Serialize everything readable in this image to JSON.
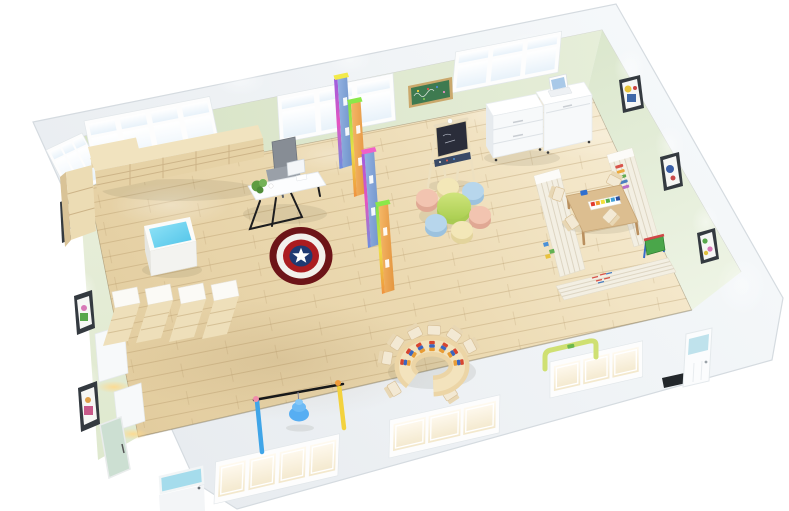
{
  "scene": {
    "title": "Kindergarten classroom 3D floor plan render",
    "description": "Top-down oblique 3D rendering of a furnished kindergarten classroom; no visible text in the image",
    "room_type": "kindergarten classroom",
    "view": "isometric bird's-eye cutaway"
  },
  "palette": {
    "bg": "#ffffff",
    "wall-outer-light": "#f5f8fa",
    "wall-outer-dark": "#e7ebef",
    "wall-edge": "#d5dbe0",
    "seam": "rgba(150,150,130,0.35)",
    "baseline": "rgba(125,115,90,0.45)",
    "wall-green-dark": "#d6e2c4",
    "wall-green-light": "#e6eed9",
    "floor-dark": "#e2cc9e",
    "floor-mid": "#ecdab2",
    "floor-light": "#f6ebd1",
    "plank-line": "rgba(172,142,94,0.33)",
    "plank-seam": "rgba(172,142,94,0.2)",
    "window-frame": "#fdfdfd",
    "door-pane-cyan": "#a5dcec",
    "glass-door-green": "#ccdfd2",
    "doormat": "#23272b",
    "wood-shelf-top": "#f1e3bf",
    "wood-shelf-front": "#e6d2a6",
    "wood-shelf-line": "#cdb488",
    "wood-cabinet": "#ecdcb4",
    "wood-cabinet-side": "#d9c397",
    "white-furn": "#f7f9fa",
    "white-furn-shade": "#e7ebee",
    "desk-white": "#fcfdfe",
    "desk-leg": "#1d1d1f",
    "chair-gray": "#878d95",
    "screen-blue": "#a9c9e8",
    "plant-green": "#5e9c41",
    "rug-maroon": "#6d1418",
    "rug-white": "#f2f0ec",
    "rug-red": "#ab1c20",
    "rug-blue": "#1f3a72",
    "divider-blue-a": "#93b2e2",
    "divider-blue-b": "#7093ca",
    "divider-orange-a": "#f5b868",
    "divider-orange-b": "#e4953f",
    "divider-cap-yellow": "#f2ea4a",
    "divider-cap-green": "#8ae84a",
    "divider-cap-magenta": "#f060c8",
    "chalk-green": "#3e7a50",
    "chalk-frame": "#caa86c",
    "easel-wood": "#ede0c0",
    "easel-board": "#2a2d3a",
    "easel-tray": "#3a4a66",
    "flower-center-side": "#a9cb52",
    "petal-pink": "#f2c4b0",
    "petal-blue": "#b7d6ec",
    "petal-cream": "#f3e7b8",
    "corner-shelf": "#f3efe3",
    "corner-shelf-line": "#ddd5c2",
    "table-wood": "#dcbe90",
    "table-wood-edge": "#c6a474",
    "chair-wood": "#e8d7b4",
    "seat-cream": "#f3e9d4",
    "paint-red": "#e23b2e",
    "paint-orange": "#f09b2d",
    "paint-yellow": "#f3df3a",
    "paint-green": "#58b04c",
    "paint-skyblue": "#3f9fd8",
    "paint-navy": "#2b4fa0",
    "toy-red": "#d64530",
    "toy-blue": "#3a66c0",
    "toy-orange": "#e89c35",
    "toy-easel-green": "#4aa64a",
    "horseshoe-wood": "#ecd5a6",
    "horseshoe-rim": "#f3e3bd",
    "step-back": "#fbfaf6",
    "step-wood": "#eedfba",
    "step-line": "#d6c196",
    "swing-bar-black": "#17181a",
    "swing-post-blue": "#3fa5e8",
    "swing-post-yellow": "#f3d23e",
    "swing-cap-pink": "#f08caa",
    "swing-cap-orange": "#f09b3a",
    "swing-hang-blue": "#57aef2",
    "bench-green": "#cfe072",
    "frame-dark": "#343a40"
  },
  "room": {
    "walls": {
      "back_wall": {
        "window_groups": 3,
        "chalkboard": true
      },
      "left_wall": {
        "window_groups": 1,
        "pictures": 3,
        "wall_cabinets": 2,
        "glass_door": true
      },
      "right_wall": {
        "pictures": 3,
        "spotlights": 4
      },
      "front_wall": {
        "window_groups": 3,
        "doors": 2,
        "doormat": true
      }
    },
    "furniture": [
      {
        "name": "open-bookshelf",
        "location": "along back wall, left side"
      },
      {
        "name": "corner-cabinet",
        "location": "top-left corner"
      },
      {
        "name": "sensory-table",
        "desc": "white cube table with cyan top"
      },
      {
        "name": "teacher-desk",
        "desc": "white desk, black trestle legs, laptop, plant, gray office chair"
      },
      {
        "name": "rainbow-dividers",
        "count": 4
      },
      {
        "name": "captain-america-rug"
      },
      {
        "name": "wall-chalkboard"
      },
      {
        "name": "easel-blackboard"
      },
      {
        "name": "white-cabinets",
        "count": 2,
        "laptop_on_top": true
      },
      {
        "name": "flower-table",
        "desc": "round green table with 6 cylinder stools (pink, blue, cream)"
      },
      {
        "name": "reading-corner",
        "desc": "U-shaped low shelving with kids table, 4 chairs, paint tray, toys, book display"
      },
      {
        "name": "horseshoe-table",
        "desc": "U-shaped activity table with small chairs and 7 striped bead toys"
      },
      {
        "name": "step-seats",
        "count": 4,
        "location": "along left wall"
      },
      {
        "name": "play-gate",
        "desc": "bar frame with blue hanging spring toy"
      },
      {
        "name": "balance-bench",
        "location": "near front wall, right"
      }
    ]
  }
}
